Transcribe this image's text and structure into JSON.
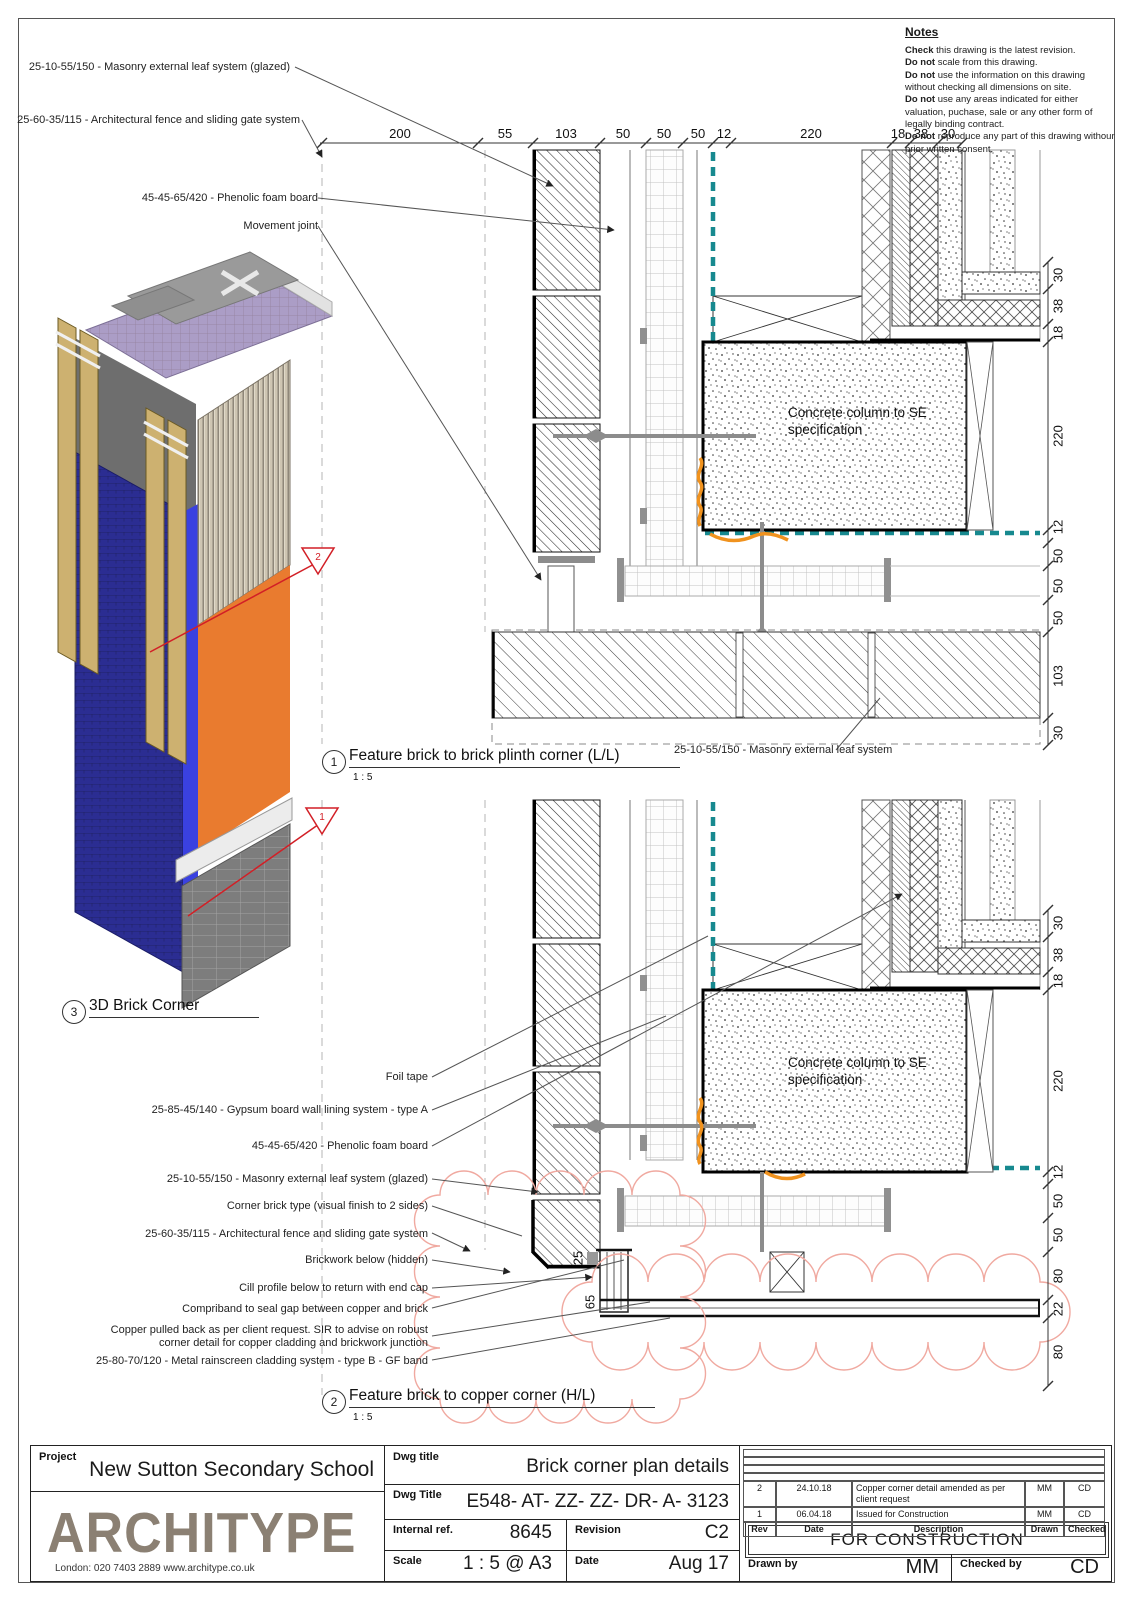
{
  "notes": {
    "title": "Notes",
    "items": [
      {
        "lead": "Check",
        "text": " this drawing is the latest revision."
      },
      {
        "lead": "Do not",
        "text": " scale from this drawing."
      },
      {
        "lead": "Do not",
        "text": " use the information on this drawing without checking all dimensions on site."
      },
      {
        "lead": "Do not",
        "text": " use any areas indicated for either valuation, puchase, sale or any other form of legally binding contract."
      },
      {
        "lead": "Do not",
        "text": " reproduce any part of this drawing withour prior written consent."
      }
    ]
  },
  "detail1": {
    "num": "1",
    "title": "Feature brick to brick plinth corner (L/L)",
    "scale": "1 : 5",
    "top_dims": [
      "200",
      "55",
      "103",
      "50",
      "50",
      "50",
      "12",
      "220",
      "18",
      "38",
      "30"
    ],
    "right_dims": [
      "30",
      "38",
      "18",
      "220",
      "12",
      "50",
      "50",
      "50",
      "103",
      "30"
    ],
    "labels": {
      "masonry_glazed": "25-10-55/150 - Masonry external leaf system (glazed)",
      "fence": "25-60-35/115 - Architectural fence and sliding gate system",
      "phenolic": "45-45-65/420 - Phenolic foam board",
      "movement": "Movement joint",
      "masonry": "25-10-55/150 - Masonry external leaf system",
      "column": "Concrete column to SE specification"
    }
  },
  "detail2": {
    "num": "2",
    "title": "Feature brick to copper corner (H/L)",
    "scale": "1 : 5",
    "right_dims": [
      "30",
      "38",
      "18",
      "220",
      "12",
      "50",
      "50",
      "80",
      "22",
      "80"
    ],
    "inner_dims": [
      "25",
      "65"
    ],
    "labels": {
      "foil": "Foil tape",
      "gypsum": "25-85-45/140 - Gypsum board wall lining system - type A",
      "phenolic": "45-45-65/420 - Phenolic foam board",
      "masonry_glazed": "25-10-55/150 - Masonry external leaf system (glazed)",
      "corner_brick": "Corner brick type (visual finish to 2 sides)",
      "fence": "25-60-35/115 - Architectural fence and sliding gate system",
      "brickwork_below": "Brickwork below (hidden)",
      "cill": "Cill profile below to return with end cap",
      "compriband": "Compriband to seal gap between copper and brick",
      "copper_note": "Copper pulled back as per client request. SIR to advise on robust corner detail for copper cladding and brickwork junction",
      "rainscreen": "25-80-70/120 - Metal rainscreen cladding system - type B - GF band",
      "column": "Concrete column to SE specification"
    }
  },
  "detail3": {
    "num": "3",
    "title": "3D Brick Corner",
    "flag_upper": "2",
    "flag_lower": "1"
  },
  "titleblock": {
    "project_label": "Project",
    "project": "New Sutton Secondary School",
    "logo": "ARCHITYPE",
    "logo_contact": "London: 020 7403 2889   www.architype.co.uk",
    "dwg_title_label": "Dwg title",
    "dwg_title": "Brick corner plan details",
    "dwg_no_label": "Dwg Title",
    "dwg_no": "E548- AT- ZZ- ZZ- DR- A- 3123",
    "internal_ref_label": "Internal ref.",
    "internal_ref": "8645",
    "revision_label": "Revision",
    "revision": "C2",
    "scale_label": "Scale",
    "scale": "1 : 5 @ A3",
    "date_label": "Date",
    "date": "Aug 17",
    "status": "FOR CONSTRUCTION",
    "drawn_label": "Drawn by",
    "drawn": "MM",
    "checked_label": "Checked by",
    "checked": "CD",
    "rev_table": {
      "headers": [
        "Rev",
        "Date",
        "Description",
        "Drawn",
        "Checked"
      ],
      "rows": [
        [
          "2",
          "24.10.18",
          "Copper corner detail amended as per client request",
          "MM",
          "CD"
        ],
        [
          "1",
          "06.04.18",
          "Issued for Construction",
          "MM",
          "CD"
        ]
      ]
    }
  },
  "colors": {
    "teal_membrane": "#17898f",
    "orange_accent": "#f0921e",
    "section_red": "#d21f26",
    "revision_cloud": "#f0a9a0",
    "logo_brown": "#8b8073",
    "brick_navy": "#2b2d92",
    "brick_blue": "#3a41e0",
    "brick_orange": "#e97b2f",
    "plinth_grey": "#7d7d7d"
  }
}
